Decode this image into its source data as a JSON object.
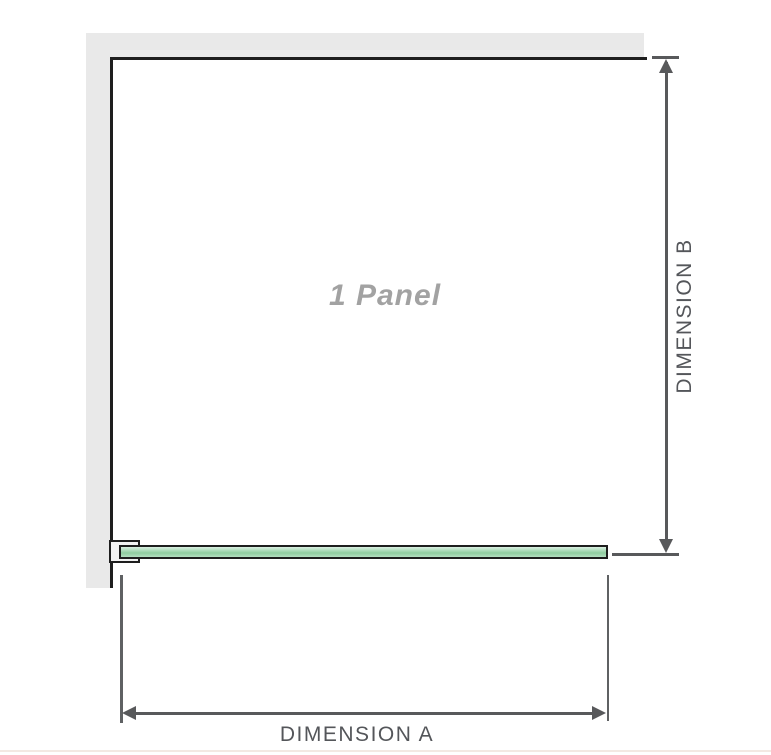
{
  "diagram": {
    "title": "1 Panel",
    "dimensions": {
      "a": {
        "label": "DIMENSION A",
        "orientation": "horizontal"
      },
      "b": {
        "label": "DIMENSION B",
        "orientation": "vertical"
      }
    },
    "icons": {
      "bracket": "wall-bracket-icon",
      "glass": "glass-panel-top-view"
    }
  },
  "colors": {
    "wall": "#e9e9e9",
    "outline": "#1e1e1e",
    "glass_light": "#daefe1",
    "glass_mid_light": "#b4dfc1",
    "glass_mid": "#8fcd9f",
    "dim_line": "#58595b",
    "ext_line": "#5f6163",
    "dim_text": "#54565a",
    "label_gray": "#a2a2a2",
    "bottom_rule": "#f3e9e3"
  }
}
